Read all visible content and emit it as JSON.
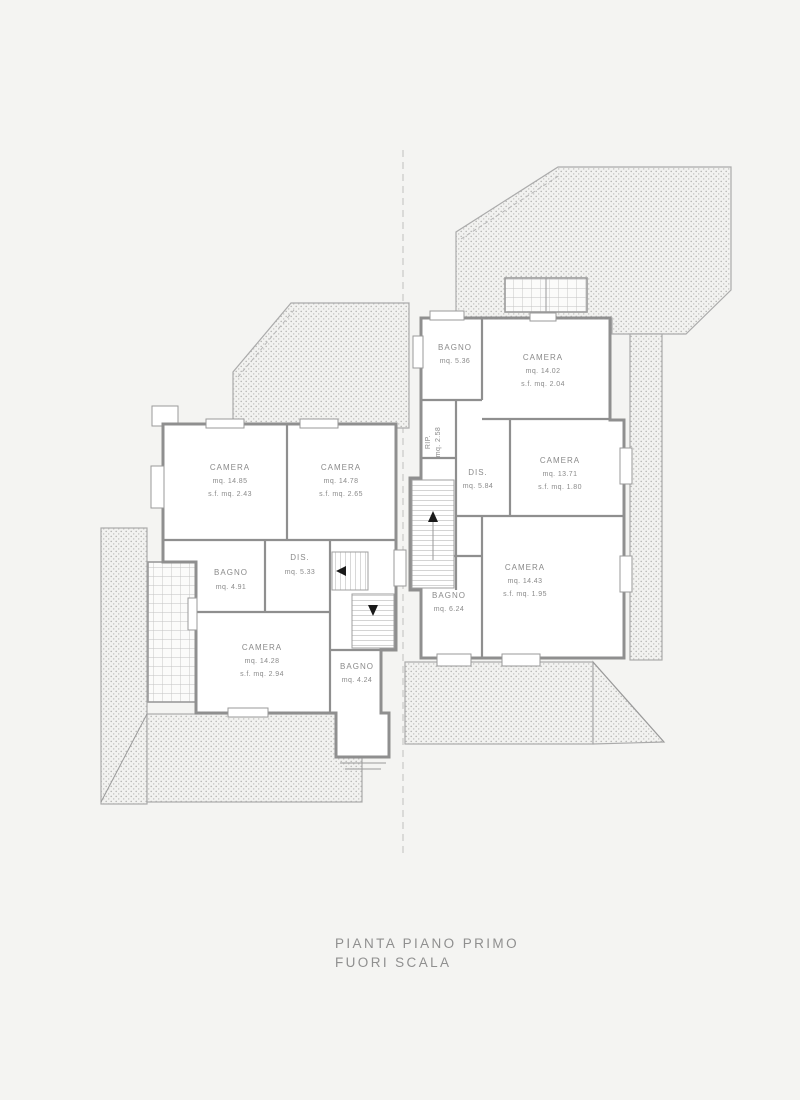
{
  "caption": {
    "title": "PIANTA PIANO PRIMO",
    "subtitle": "FUORI SCALA"
  },
  "colors": {
    "background": "#f4f4f2",
    "wall_line": "#8f8f8f",
    "hatch_line": "#b8b8b8",
    "text": "#8a8a8a",
    "arrow": "#1a1a1a"
  },
  "units": {
    "left": {
      "rooms": [
        {
          "label": "CAMERA",
          "area": "mq. 14.85",
          "sf": "s.f. mq. 2.43"
        },
        {
          "label": "CAMERA",
          "area": "mq. 14.78",
          "sf": "s.f. mq. 2.65"
        },
        {
          "label": "BAGNO",
          "area": "mq. 4.91"
        },
        {
          "label": "DIS.",
          "area": "mq. 5.33"
        },
        {
          "label": "CAMERA",
          "area": "mq. 14.28",
          "sf": "s.f. mq. 2.94"
        },
        {
          "label": "BAGNO",
          "area": "mq. 4.24"
        }
      ]
    },
    "right": {
      "rooms": [
        {
          "label": "BAGNO",
          "area": "mq. 5.36"
        },
        {
          "label": "CAMERA",
          "area": "mq. 14.02",
          "sf": "s.f. mq. 2.04"
        },
        {
          "label": "RIP.",
          "area": "mq. 2.58"
        },
        {
          "label": "DIS.",
          "area": "mq. 5.84"
        },
        {
          "label": "CAMERA",
          "area": "mq. 13.71",
          "sf": "s.f. mq. 1.80"
        },
        {
          "label": "BAGNO",
          "area": "mq. 6.24"
        },
        {
          "label": "CAMERA",
          "area": "mq. 14.43",
          "sf": "s.f. mq. 1.95"
        }
      ]
    }
  }
}
